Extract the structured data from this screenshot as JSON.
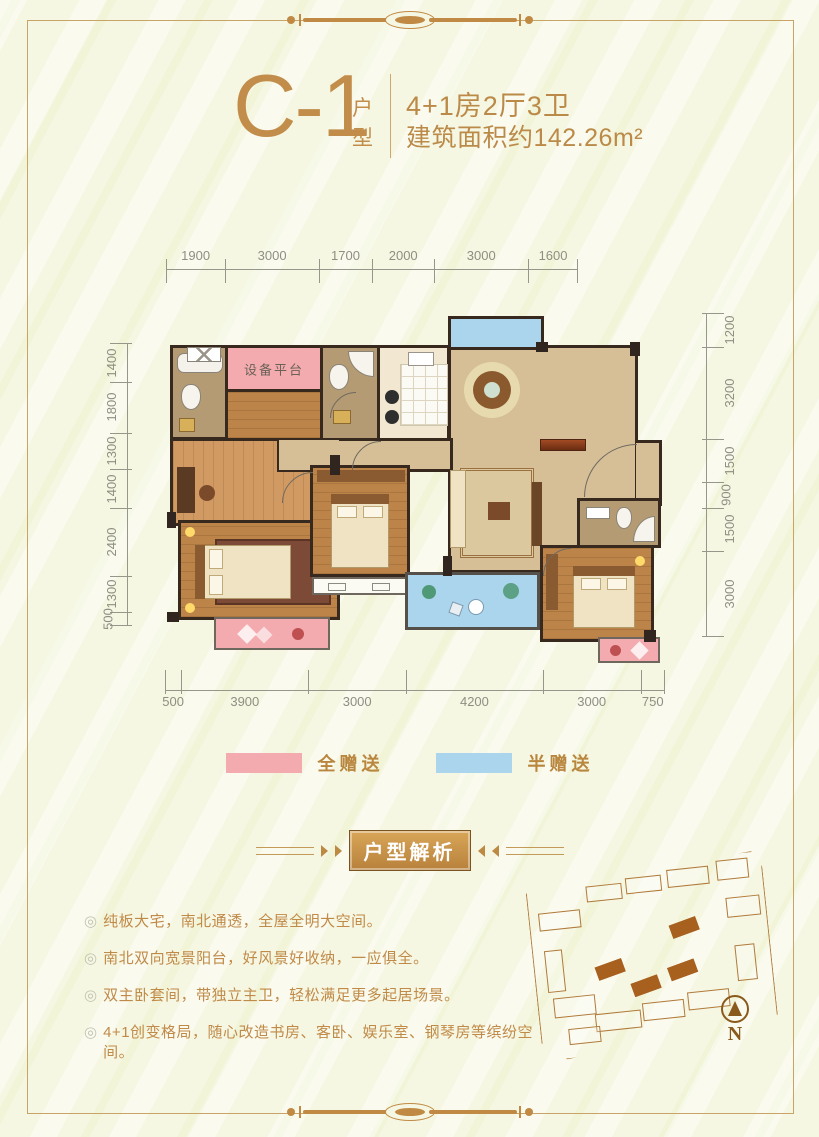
{
  "header": {
    "unit_code": "C-1",
    "unit_suffix": "户型",
    "spec_line1": "4+1房2厅3卫",
    "spec_line2": "建筑面积约142.26m²"
  },
  "plan": {
    "equipment_platform_label": "设备平台",
    "dimensions": {
      "top": [
        "1900",
        "3000",
        "1700",
        "2000",
        "3000",
        "1600"
      ],
      "bottom": [
        "500",
        "3900",
        "3000",
        "4200",
        "3000",
        "750"
      ],
      "left": [
        "1400",
        "1800",
        "1300",
        "1400",
        "2400",
        "1300",
        "500"
      ],
      "right": [
        "1200",
        "3200",
        "1500",
        "900",
        "1500",
        "3000"
      ]
    }
  },
  "legend": {
    "full_gift": {
      "label": "全赠送",
      "color": "#f3abaf"
    },
    "half_gift": {
      "label": "半赠送",
      "color": "#aad5ec"
    }
  },
  "analysis": {
    "banner": "户型解析",
    "bullets": [
      "纯板大宅，南北通透，全屋全明大空间。",
      "南北双向宽景阳台，好风景好收纳，一应俱全。",
      "双主卧套间，带独立主卫，轻松满足更多起居场景。",
      "4+1创变格局，随心改造书房、客卧、娱乐室、钢琴房等缤纷空间。"
    ],
    "bullet_icon": "◎"
  },
  "sitemap": {
    "north_label": "N"
  }
}
